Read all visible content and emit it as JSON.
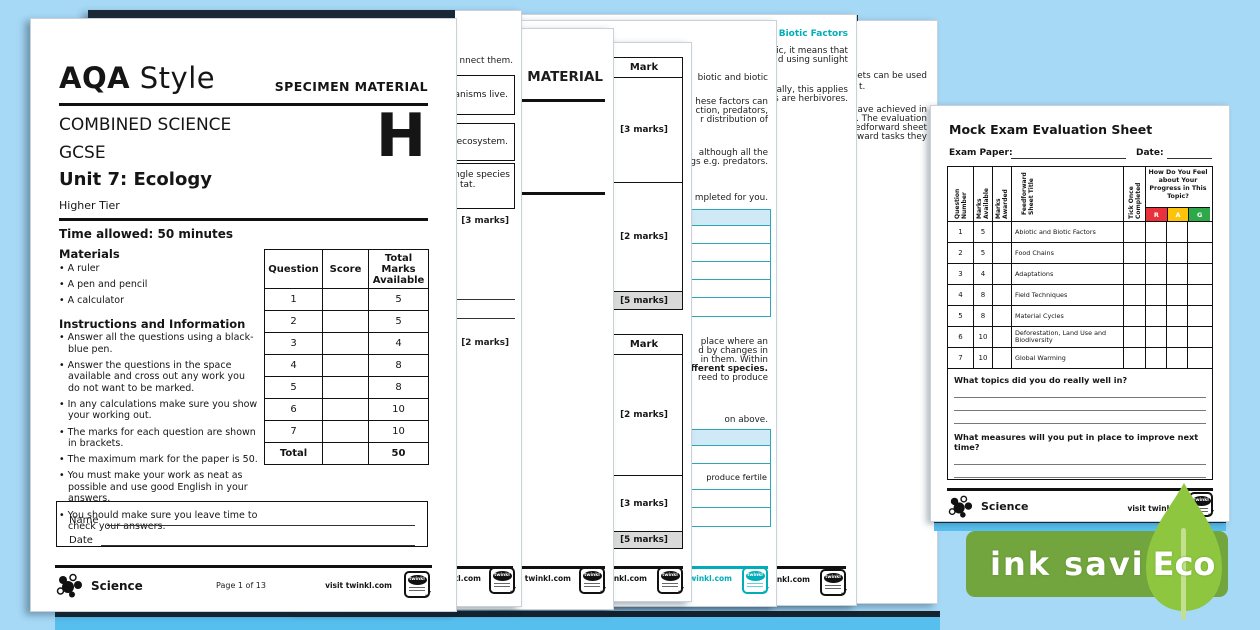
{
  "background_color": "#a6d9f6",
  "accent_teal": "#00adb8",
  "rag_colors": {
    "r": "#e8313a",
    "a": "#fdc30a",
    "g": "#2fa849"
  },
  "front_page": {
    "brand_bold": "AQA",
    "brand_regular": "Style",
    "specimen_label": "SPECIMEN MATERIAL",
    "course_line1": "COMBINED SCIENCE",
    "course_line2": "GCSE",
    "unit_title": "Unit 7: Ecology",
    "tier_label": "Higher Tier",
    "tier_letter": "H",
    "time_allowed": "Time allowed: 50 minutes",
    "materials": {
      "heading": "Materials",
      "items": [
        "A ruler",
        "A pen and pencil",
        "A calculator"
      ]
    },
    "instructions": {
      "heading": "Instructions and Information",
      "items": [
        "Answer all the questions using a black-blue pen.",
        "Answer the questions in the space available and cross out any work you do not want to be marked.",
        "In any calculations make sure you show your working out.",
        "The marks for each question are shown in brackets.",
        "The maximum mark for the paper is 50.",
        "You must make your work as neat as possible and use good English in your answers.",
        "You should make sure you leave time to check your answers."
      ]
    },
    "marks_table": {
      "headers": [
        "Question",
        "Score",
        "Total Marks Available"
      ],
      "rows": [
        [
          "1",
          "",
          "5"
        ],
        [
          "2",
          "",
          "5"
        ],
        [
          "3",
          "",
          "4"
        ],
        [
          "4",
          "",
          "8"
        ],
        [
          "5",
          "",
          "8"
        ],
        [
          "6",
          "",
          "10"
        ],
        [
          "7",
          "",
          "10"
        ]
      ],
      "total_row": [
        "Total",
        "",
        "50"
      ]
    },
    "name_label": "Name",
    "date_label": "Date",
    "footer": {
      "brand": "Science",
      "page_info": "Page 1 of 13",
      "visit": "visit twinkl.com",
      "badge": "twinkl"
    }
  },
  "stacked_pages": {
    "page2": {
      "intro_fragment": "nnect them.",
      "box1": "rganisms live.",
      "box2": "n an ecosystem.",
      "box3_line1": "a single species",
      "box3_line2": "tat.",
      "marks1": "[3 marks]",
      "marks2": "[2 marks]",
      "footer_visit": "visit twinkl.com",
      "badge": "twinkl"
    },
    "page3": {
      "header_fragment": "MATERIAL",
      "footer_visit": "visit twinkl.com",
      "badge": "twinkl"
    },
    "page4": {
      "mark_header": "Mark",
      "table1": [
        "[3 marks]",
        "[2 marks]",
        "[5 marks]"
      ],
      "table2": [
        "[2 marks]",
        "[3 marks]",
        "[5 marks]"
      ],
      "footer_visit": "visit twinkl.com",
      "badge": "twinkl"
    },
    "page5": {
      "lines_top": [
        "biotic and biotic",
        "hese factors can",
        "ction, predators,",
        "r distribution of",
        "although all the",
        "gs e.g. predators.",
        "mpleted for you."
      ],
      "lines_mid": [
        "place where an",
        "d by changes in",
        "in them. Within",
        "ifferent species.",
        "reed to produce"
      ],
      "line_bottom": "on above.",
      "table2_cell": "produce  fertile",
      "footer_visit": "visit twinkl.com",
      "badge": "twinkl"
    },
    "page6": {
      "header_fragment": "ic and Biotic Factors",
      "lines": [
        "ic, it means that",
        "d using sunlight",
        "ally, this applies",
        "s are herbivores."
      ],
      "footer_visit": "visit twinkl.com",
      "badge": "twinkl"
    },
    "page7": {
      "lines": [
        "eets can be used",
        "t.",
        "have achieved in",
        "s. The evaluation",
        "eedforward sheet",
        "rward tasks they"
      ]
    }
  },
  "evaluation_sheet": {
    "title": "Mock Exam Evaluation Sheet",
    "exam_paper_label": "Exam Paper:",
    "date_label": "Date:",
    "table": {
      "col_question": "Question Number",
      "col_marks_available": "Marks Available",
      "col_marks_awarded": "Marks Awarded",
      "col_feedforward": "Feedforward Sheet Title",
      "col_tick": "Tick Once Completed",
      "col_rag": "How Do You Feel about Your Progress in This Topic?",
      "rag_letters": [
        "R",
        "A",
        "G"
      ],
      "rows": [
        {
          "num": "1",
          "marks": "5",
          "title": "Abiotic and Biotic Factors"
        },
        {
          "num": "2",
          "marks": "5",
          "title": "Food Chains"
        },
        {
          "num": "3",
          "marks": "4",
          "title": "Adaptations"
        },
        {
          "num": "4",
          "marks": "8",
          "title": "Field Techniques"
        },
        {
          "num": "5",
          "marks": "8",
          "title": "Material Cycles"
        },
        {
          "num": "6",
          "marks": "10",
          "title": "Deforestation, Land Use and Biodiversity"
        },
        {
          "num": "7",
          "marks": "10",
          "title": "Global Warming"
        }
      ]
    },
    "question1": "What topics did you do really well in?",
    "question2": "What measures will you put in place to improve next time?",
    "footer": {
      "brand": "Science",
      "visit": "visit twinkl.",
      "badge": "twinkl"
    }
  },
  "eco_badge": {
    "text": "ink saving",
    "leaf_label": "Eco",
    "banner_color": "#72a53e",
    "leaf_color": "#8ec63f"
  }
}
